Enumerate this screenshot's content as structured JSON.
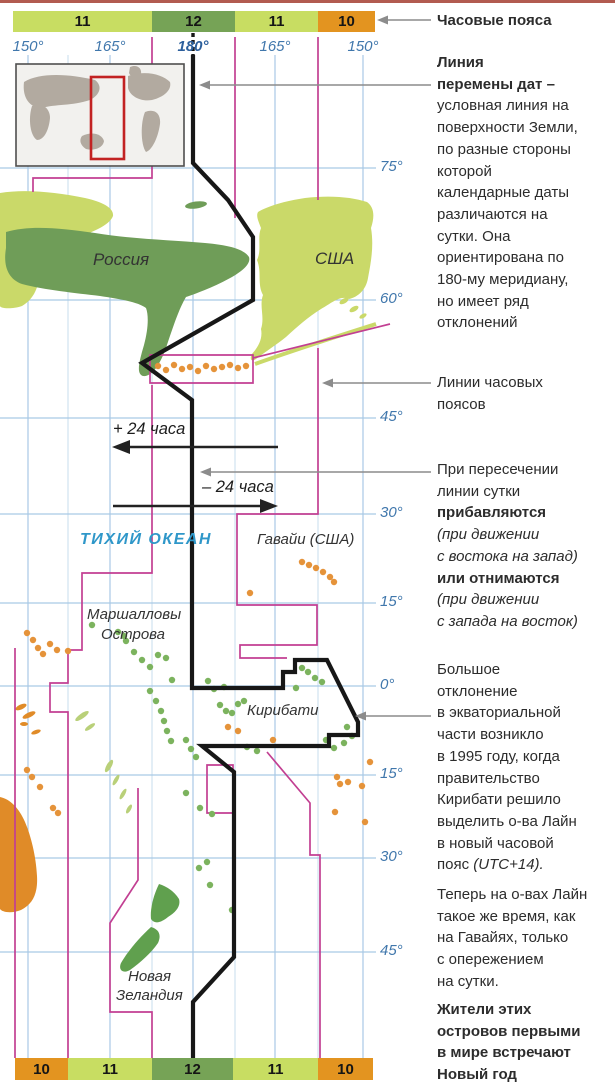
{
  "colors": {
    "band_light": "#c8dd62",
    "band_dark": "#76a356",
    "band_orange": "#e39420",
    "land_light": "#cad969",
    "land_dark": "#6f9d58",
    "nz_green": "#60a04e",
    "island_green": "#7cb35e",
    "island_orange": "#e5933a",
    "sliver_green": "#b9d079",
    "aus_orange": "#e08b28",
    "grid_blue": "#a9c9e5",
    "label_blue": "#4077ac",
    "label_180": "#2c5f9c",
    "zone_magenta": "#c23f92",
    "dateline_black": "#171717",
    "callout_gray": "#8c8c8c",
    "ocean_label": "#2f97c9",
    "inset_land": "#b2aaa0",
    "inset_red": "#c22222"
  },
  "top_band": {
    "y": 11,
    "h": 21,
    "segments": [
      {
        "label": "11",
        "x": 13,
        "w": 139,
        "c": "light"
      },
      {
        "label": "12",
        "x": 152,
        "w": 83,
        "c": "dark"
      },
      {
        "label": "11",
        "x": 235,
        "w": 83,
        "c": "light"
      },
      {
        "label": "10",
        "x": 318,
        "w": 57,
        "c": "orange"
      }
    ]
  },
  "bottom_band": {
    "y": 1058,
    "h": 22,
    "segments": [
      {
        "label": "10",
        "x": 15,
        "w": 53,
        "c": "orange"
      },
      {
        "label": "11",
        "x": 68,
        "w": 84,
        "c": "light"
      },
      {
        "label": "12",
        "x": 152,
        "w": 81,
        "c": "dark"
      },
      {
        "label": "11",
        "x": 233,
        "w": 85,
        "c": "light"
      },
      {
        "label": "10",
        "x": 318,
        "w": 55,
        "c": "orange"
      }
    ]
  },
  "graticule": {
    "latitudes": [
      {
        "y": 168,
        "label": "75°"
      },
      {
        "y": 300,
        "label": "60°"
      },
      {
        "y": 418,
        "label": "45°"
      },
      {
        "y": 514,
        "label": "30°"
      },
      {
        "y": 603,
        "label": "15°"
      },
      {
        "y": 686,
        "label": "0°"
      },
      {
        "y": 775,
        "label": "15°"
      },
      {
        "y": 858,
        "label": "30°"
      },
      {
        "y": 952,
        "label": "45°"
      }
    ],
    "longitudes": [
      {
        "x": 28,
        "label": "150°"
      },
      {
        "x": 110,
        "label": "165°"
      },
      {
        "x": 193,
        "label": "180°",
        "bold": true
      },
      {
        "x": 275,
        "label": "165°"
      },
      {
        "x": 363,
        "label": "150°"
      }
    ],
    "secondary_x": [
      68,
      152,
      235,
      318
    ]
  },
  "map_labels": [
    {
      "text": "Россия",
      "x": 93,
      "y": 250,
      "cls": "country"
    },
    {
      "text": "США",
      "x": 315,
      "y": 249,
      "cls": "country"
    },
    {
      "text": "ТИХИЙ ОКЕАН",
      "x": 80,
      "y": 531,
      "cls": "ocean"
    },
    {
      "text": "Гавайи (США)",
      "x": 257,
      "y": 531,
      "cls": "place"
    },
    {
      "text": "Маршалловы",
      "x": 87,
      "y": 606,
      "cls": "place"
    },
    {
      "text": "Острова",
      "x": 101,
      "y": 626,
      "cls": "place"
    },
    {
      "text": "Кирибати",
      "x": 247,
      "y": 702,
      "cls": "place"
    },
    {
      "text": "Новая",
      "x": 128,
      "y": 968,
      "cls": "place"
    },
    {
      "text": "Зеландия",
      "x": 116,
      "y": 987,
      "cls": "place"
    },
    {
      "text": "+ 24 часа",
      "x": 113,
      "y": 420,
      "cls": "hours"
    },
    {
      "text": "– 24 часа",
      "x": 202,
      "y": 478,
      "cls": "hours"
    }
  ],
  "islands": {
    "green": [
      [
        92,
        625
      ],
      [
        118,
        632
      ],
      [
        126,
        641
      ],
      [
        134,
        652
      ],
      [
        142,
        660
      ],
      [
        150,
        667
      ],
      [
        158,
        655
      ],
      [
        166,
        658
      ],
      [
        172,
        680
      ],
      [
        124,
        636
      ],
      [
        208,
        681
      ],
      [
        214,
        689
      ],
      [
        220,
        705
      ],
      [
        226,
        711
      ],
      [
        232,
        713
      ],
      [
        238,
        704
      ],
      [
        244,
        701
      ],
      [
        224,
        687
      ],
      [
        296,
        688
      ],
      [
        302,
        668
      ],
      [
        308,
        672
      ],
      [
        315,
        678
      ],
      [
        322,
        682
      ],
      [
        347,
        727
      ],
      [
        352,
        736
      ],
      [
        344,
        743
      ],
      [
        334,
        748
      ],
      [
        326,
        740
      ],
      [
        150,
        691
      ],
      [
        156,
        701
      ],
      [
        161,
        711
      ],
      [
        164,
        721
      ],
      [
        167,
        731
      ],
      [
        171,
        741
      ],
      [
        186,
        740
      ],
      [
        191,
        749
      ],
      [
        196,
        757
      ],
      [
        186,
        793
      ],
      [
        200,
        808
      ],
      [
        212,
        814
      ],
      [
        207,
        862
      ],
      [
        199,
        868
      ],
      [
        210,
        885
      ],
      [
        232,
        910
      ],
      [
        247,
        747
      ],
      [
        257,
        751
      ]
    ],
    "orange": [
      [
        158,
        366
      ],
      [
        166,
        370
      ],
      [
        174,
        365
      ],
      [
        182,
        369
      ],
      [
        190,
        367
      ],
      [
        198,
        371
      ],
      [
        206,
        366
      ],
      [
        214,
        369
      ],
      [
        222,
        367
      ],
      [
        230,
        365
      ],
      [
        238,
        368
      ],
      [
        246,
        366
      ],
      [
        302,
        562
      ],
      [
        309,
        565
      ],
      [
        316,
        568
      ],
      [
        323,
        572
      ],
      [
        330,
        577
      ],
      [
        334,
        582
      ],
      [
        250,
        593
      ],
      [
        27,
        633
      ],
      [
        33,
        640
      ],
      [
        38,
        648
      ],
      [
        43,
        654
      ],
      [
        50,
        644
      ],
      [
        57,
        650
      ],
      [
        68,
        651
      ],
      [
        27,
        770
      ],
      [
        32,
        777
      ],
      [
        40,
        787
      ],
      [
        53,
        808
      ],
      [
        58,
        813
      ],
      [
        228,
        727
      ],
      [
        238,
        731
      ],
      [
        273,
        740
      ],
      [
        337,
        777
      ],
      [
        348,
        782
      ],
      [
        370,
        762
      ],
      [
        335,
        812
      ],
      [
        365,
        822
      ],
      [
        340,
        784
      ],
      [
        362,
        786
      ]
    ]
  },
  "annotations": {
    "blocks": [
      {
        "name": "timezones-label",
        "y": 10,
        "lines": [
          {
            "t": "Часовые пояса",
            "b": true
          }
        ]
      },
      {
        "name": "dateline-note",
        "y": 52,
        "lines": [
          {
            "t": "Линия",
            "b": true
          },
          {
            "t": "перемены дат –",
            "b": true
          },
          {
            "t": "условная линия на"
          },
          {
            "t": "поверхности Земли,"
          },
          {
            "t": "по разные стороны"
          },
          {
            "t": "которой"
          },
          {
            "t": "календарные даты"
          },
          {
            "t": "различаются на"
          },
          {
            "t": "сутки. Она"
          },
          {
            "t": "ориентирована по"
          },
          {
            "t": "180-му меридиану,"
          },
          {
            "t": "но имеет ряд"
          },
          {
            "t": "отклонений"
          }
        ]
      },
      {
        "name": "zonelines-note",
        "y": 372,
        "lines": [
          {
            "t": "Линии часовых"
          },
          {
            "t": "поясов"
          }
        ]
      },
      {
        "name": "crossing-note",
        "y": 459,
        "lines": [
          {
            "t": "При пересечении"
          },
          {
            "t": "линии сутки"
          },
          {
            "t": "прибавляются",
            "b": true
          },
          {
            "t": "(при движении",
            "i": true
          },
          {
            "t": "с востока на запад)",
            "i": true
          },
          {
            "t": "или отнимаются",
            "b": true
          },
          {
            "t": "(при движении",
            "i": true
          },
          {
            "t": "с запада на восток)",
            "i": true
          }
        ]
      },
      {
        "name": "deviation-note",
        "y": 659,
        "lines": [
          {
            "t": "Большое"
          },
          {
            "t": "отклонение"
          },
          {
            "t": "в экваториальной"
          },
          {
            "t": "части возникло"
          },
          {
            "t": "в 1995 году, когда"
          },
          {
            "t": "правительство"
          },
          {
            "t": "Кирибати решило"
          },
          {
            "t": "выделить о-ва Лайн"
          },
          {
            "t": "в новый часовой"
          },
          {
            "t": "пояс ",
            "tail": "(UTC+14)."
          }
        ]
      },
      {
        "name": "line-islands-note",
        "y": 884,
        "lines": [
          {
            "t": "Теперь на о-вах Лайн"
          },
          {
            "t": "такое же время, как"
          },
          {
            "t": "на Гавайях, только"
          },
          {
            "t": "с опережением"
          },
          {
            "t": "на сутки."
          }
        ]
      },
      {
        "name": "newyear-note",
        "y": 999,
        "lines": [
          {
            "t": "Жители этих",
            "b": true
          },
          {
            "t": "островов первыми",
            "b": true
          },
          {
            "t": "в мире встречают",
            "b": true
          },
          {
            "t": "Новый год",
            "b": true
          }
        ]
      }
    ]
  }
}
